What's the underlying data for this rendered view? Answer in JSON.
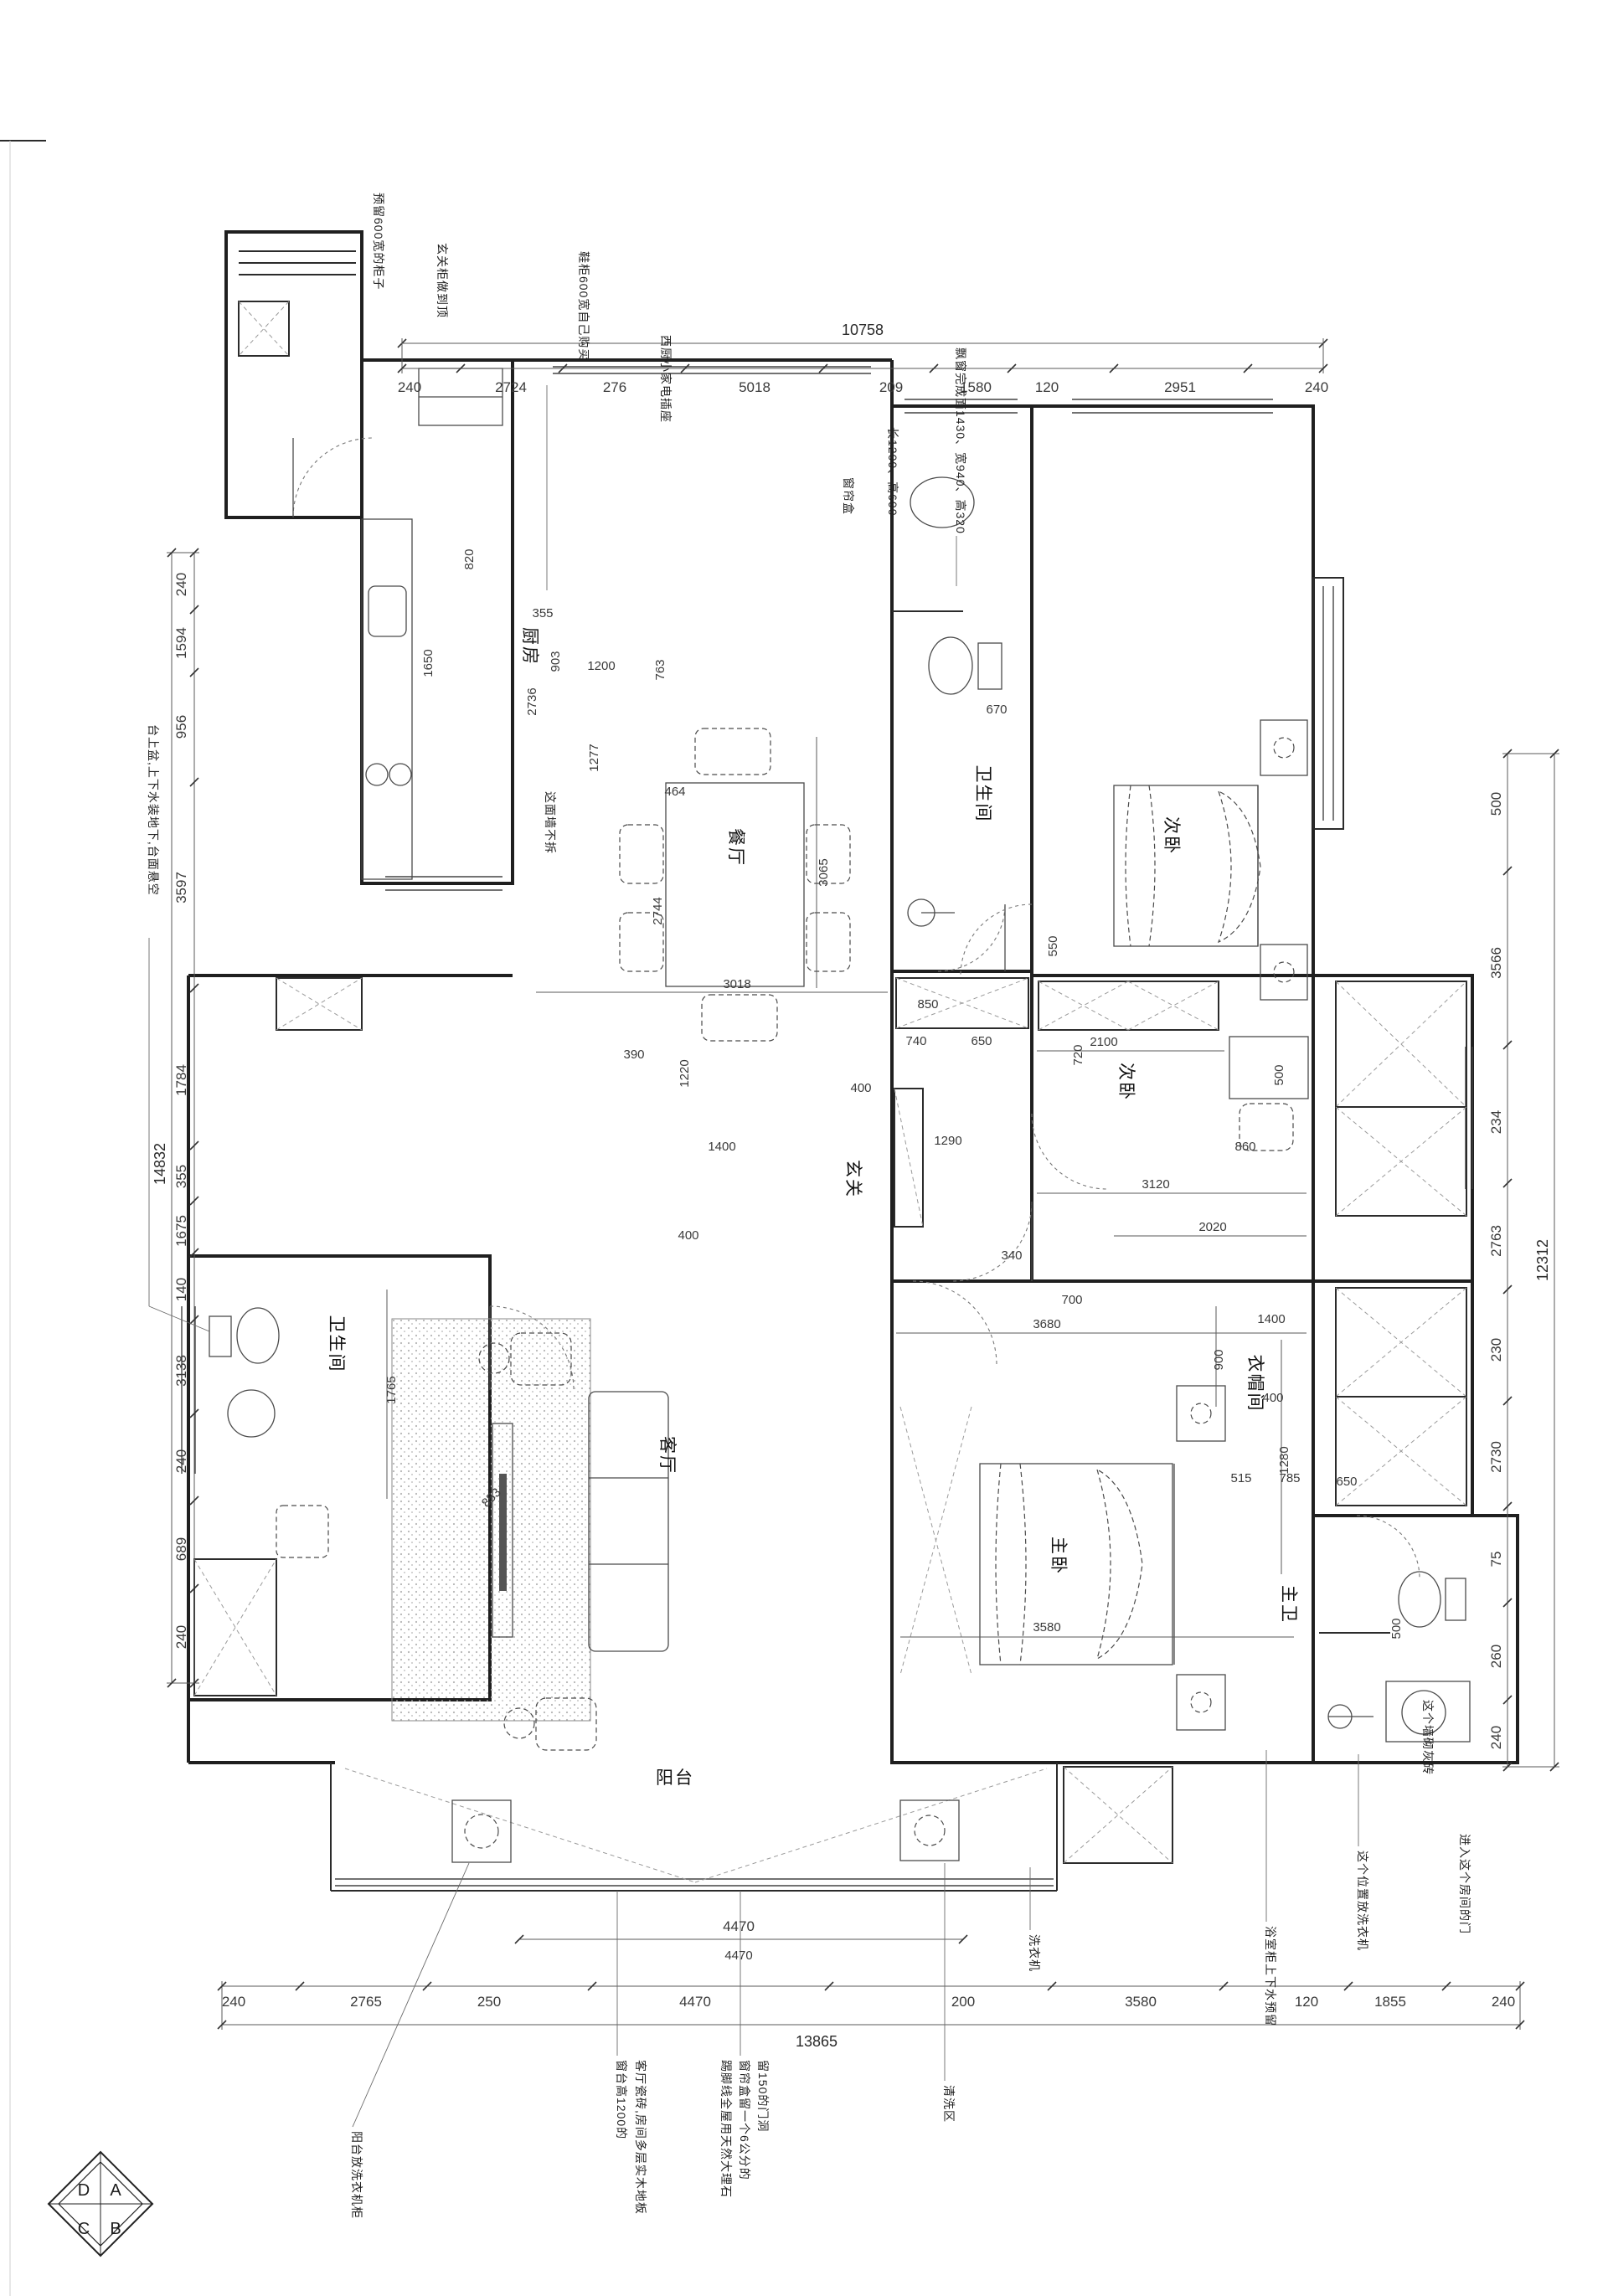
{
  "compass": [
    "A",
    "B",
    "C",
    "D"
  ],
  "rooms": [
    "厨房",
    "餐厅",
    "卫生间",
    "次卧",
    "次卧",
    "玄关",
    "客厅",
    "卫生间",
    "主卧",
    "衣帽间",
    "主卫",
    "阳台"
  ],
  "notes": [
    "预留600宽的柜子",
    "玄关柜做到顶",
    "鞋柜600宽自己购买",
    "西厨小家电插座",
    "窗帘盒",
    "长1200、高600",
    "飘窗完成面1430、宽940、高320",
    "台上盆,上下水装地下,台面悬空",
    "这面墙不拆",
    "这个墙砌灰砖",
    "浴室柜上下水预留",
    "这个位置放洗衣机",
    "进入这个房间的门",
    "阳台放洗衣机柜",
    "窗台高1200的",
    "客厅瓷砖,房间多层实木地板",
    "踢脚线全屋用天然大理石",
    "窗帘盒留一个6公分的",
    "留150的门洞",
    "清洗区",
    "洗衣机"
  ],
  "dims": {
    "top": {
      "total": "10758",
      "segs": [
        "240",
        "2724",
        "276",
        "5018",
        "209",
        "1580",
        "120",
        "2951",
        "240"
      ]
    },
    "bottom": {
      "total": "13865",
      "balcony": "4470",
      "segs": [
        "240",
        "2765",
        "250",
        "4470",
        "200",
        "3580",
        "120",
        "1855",
        "240"
      ]
    },
    "left": {
      "total": "14832",
      "segs": [
        "240",
        "1594",
        "956",
        "3597",
        "1784",
        "355",
        "1675",
        "140",
        "3138",
        "240",
        "689",
        "240"
      ]
    },
    "right": {
      "total": "12312",
      "segs": [
        "500",
        "3566",
        "234",
        "2763",
        "230",
        "2730",
        "75",
        "260",
        "240"
      ]
    },
    "inner": [
      "820",
      "1650",
      "2736",
      "903",
      "355",
      "1200",
      "763",
      "1277",
      "464",
      "3065",
      "3018",
      "2744",
      "670",
      "850",
      "740",
      "650",
      "550",
      "390",
      "1220",
      "400",
      "1400",
      "400",
      "1290",
      "2100",
      "720",
      "500",
      "860",
      "3120",
      "2020",
      "700",
      "340",
      "3680",
      "3580",
      "900",
      "1400",
      "400",
      "1280",
      "515",
      "785",
      "650",
      "500",
      "1765",
      "853",
      "4470"
    ]
  }
}
